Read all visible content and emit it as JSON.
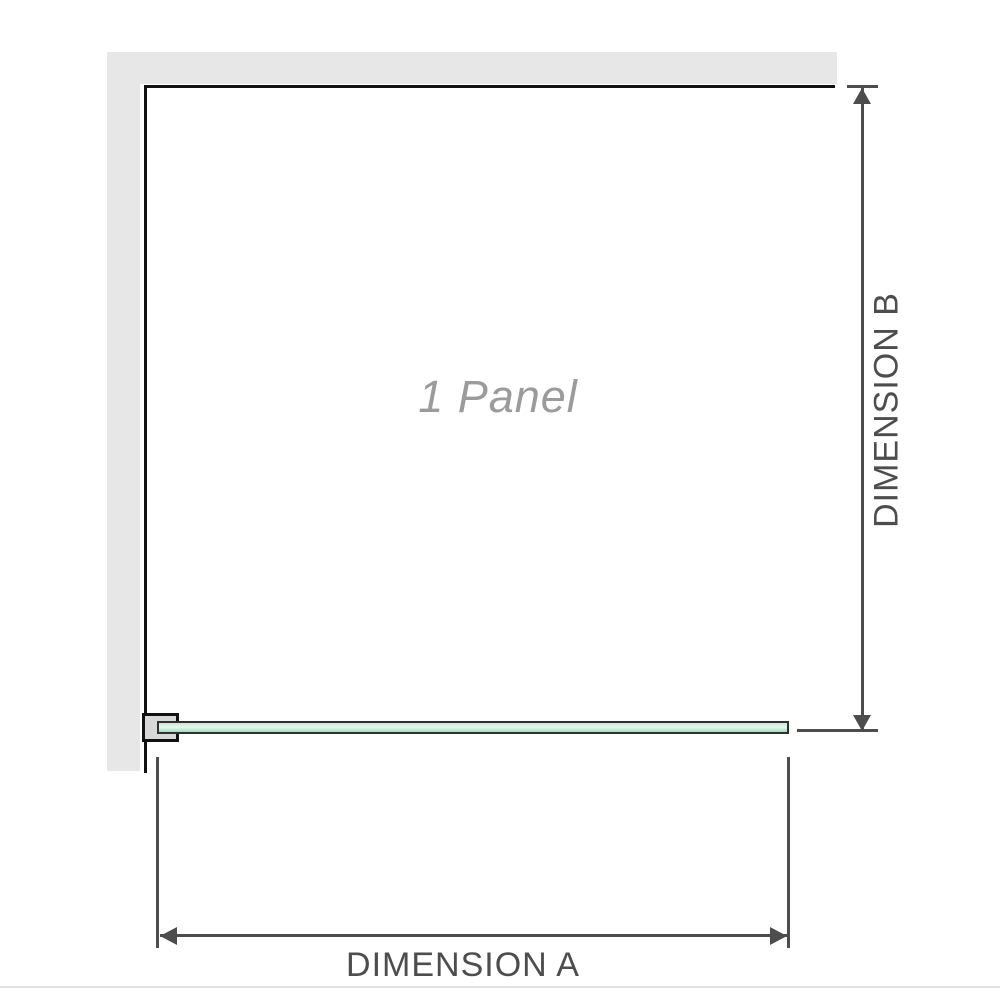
{
  "diagram": {
    "panel": {
      "label": "1 Panel"
    },
    "dimensions": {
      "a": {
        "label": "DIMENSION A",
        "orientation": "horizontal"
      },
      "b": {
        "label": "DIMENSION B",
        "orientation": "vertical"
      }
    }
  },
  "colors": {
    "background": "#ffffff",
    "wall_fill": "#e7e7e7",
    "wall_edge": "#111111",
    "bracket_fill": "#d8d8d8",
    "glass_fill": "#bfe9d3",
    "glass_fill_light": "#e9f8f0",
    "glass_fill_dark": "#a0dcbe",
    "glass_border": "#2a332d",
    "dimension_line": "#4d4d4d",
    "label_gray": "#9b9b9b",
    "baseline_rule": "#e3e3e3"
  }
}
